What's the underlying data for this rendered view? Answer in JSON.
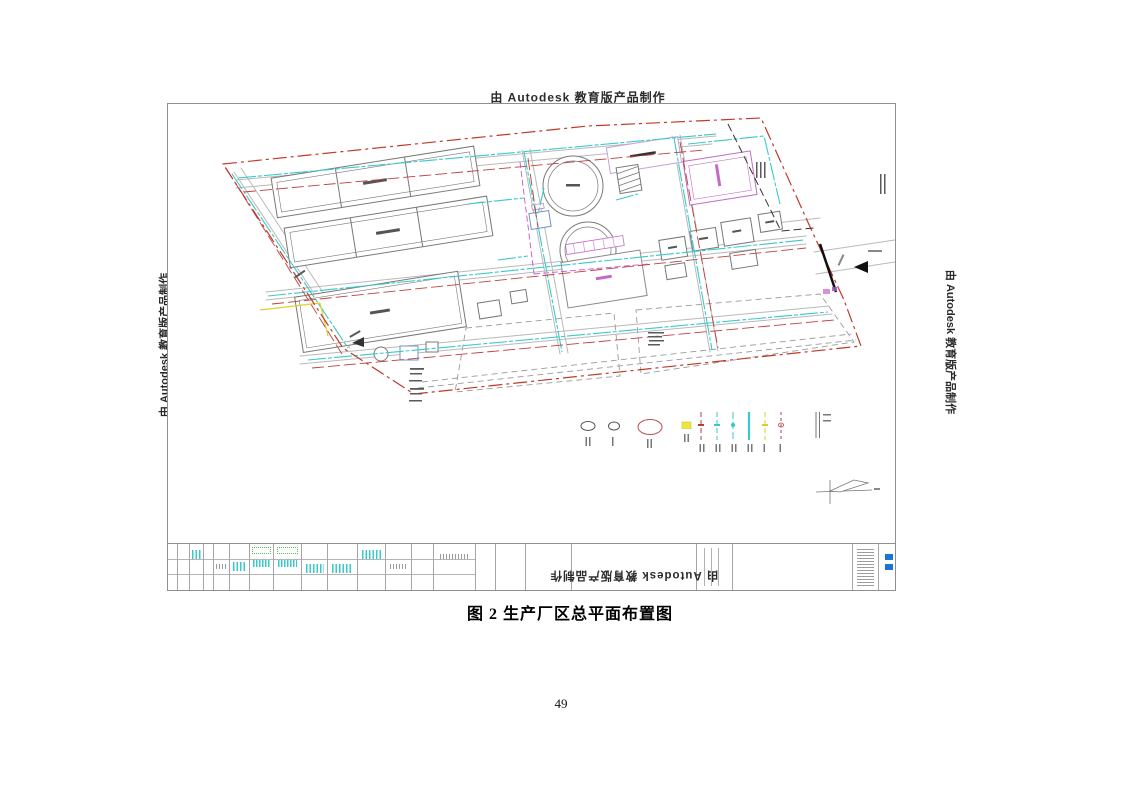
{
  "document": {
    "caption": "图 2  生产厂区总平面布置图",
    "page_number": "49"
  },
  "watermarks": {
    "text": "由 Autodesk 教育版产品制作",
    "positions": [
      "top-horizontal",
      "bottom-rotated-180",
      "left-rotated-270",
      "right-rotated-90"
    ]
  },
  "drawing": {
    "title": "生产厂区总平面布置图",
    "colors": {
      "site_boundary_red": "#c0392b",
      "road_gray": "#b9b9b9",
      "building_outline": "#787878",
      "pipe_cyan": "#3ac9c9",
      "pipe_red": "#c04040",
      "accent_magenta": "#c36cc3",
      "accent_yellow": "#e0cf30",
      "accent_green": "#57b857",
      "titleblock_logo_blue": "#1b74d6"
    },
    "features": [
      "red-dash-dot-site-boundary",
      "three-rectangular-basins",
      "two-circular-tanks",
      "magenta-outlined-buildings",
      "small-building-cluster-east",
      "internal-road-network",
      "cyan-pipe-network",
      "red-pipe-network",
      "yellow-and-magenta-pipe-segments",
      "reserved-land-parcels-dashed",
      "east-entrance-gate-with-arrow",
      "legend-row",
      "north-arrow-compass",
      "illegible-scale-note-block",
      "title-block-table-with-tiny-cyan-green-text"
    ],
    "legend": {
      "symbols": [
        {
          "name": "ellipse-small-dark",
          "color": "#555555"
        },
        {
          "name": "ellipse-small-dark-2",
          "color": "#555555"
        },
        {
          "name": "ellipse-large-red",
          "color": "#b95050"
        },
        {
          "name": "marker-yellow-square",
          "color": "#ece83a"
        },
        {
          "name": "pipeline-darkred-dashed",
          "color": "#b04040"
        },
        {
          "name": "pipeline-cyan-dashed",
          "color": "#3ac9c9"
        },
        {
          "name": "pipeline-cyan-dashed-2",
          "color": "#3ac9c9"
        },
        {
          "name": "pipeline-cyan-solid-thick",
          "color": "#3ac9c9"
        },
        {
          "name": "pipeline-yellow-dashed",
          "color": "#d8cf30"
        },
        {
          "name": "pipeline-darkred-dashed-2",
          "color": "#b04040"
        },
        {
          "name": "double-line-fence",
          "color": "#777777"
        }
      ],
      "labels": "illegible-small-text"
    },
    "notes": {
      "scale_note": "illegible-small-text",
      "parcel_label": "illegible-small-text",
      "title_block_text": "illegible-small-text"
    }
  }
}
